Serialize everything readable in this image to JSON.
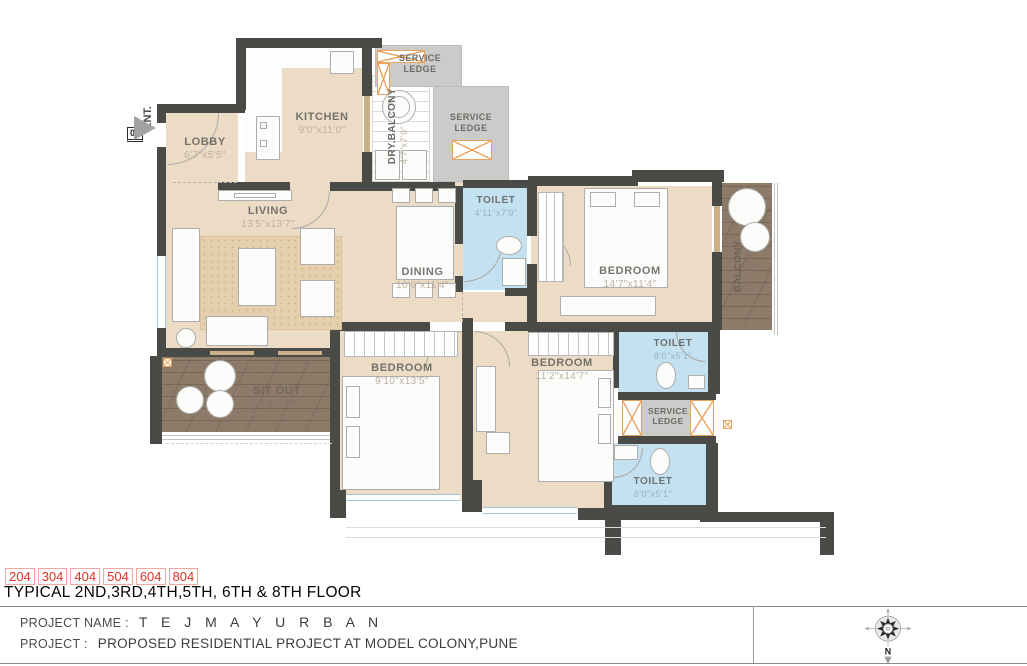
{
  "plan": {
    "entrance": {
      "unit": "04",
      "label": "ENT."
    },
    "rooms": {
      "lobby": {
        "name": "LOBBY",
        "dims": "6'7\"x5'5\""
      },
      "kitchen": {
        "name": "KITCHEN",
        "dims": "9'0\"x11'0\""
      },
      "dry_balcony": {
        "name": "DRY.BALCONY",
        "dims": "4'7\"x7'9\""
      },
      "service_ledge_top": {
        "name": "SERVICE LEDGE"
      },
      "service_ledge_right": {
        "name": "SERVICE LEDGE"
      },
      "service_ledge_mid": {
        "name": "SERVICE LEDGE"
      },
      "living": {
        "name": "LIVING",
        "dims": "13'5\"x13'7\""
      },
      "dining": {
        "name": "DINING",
        "dims": "10'6\"x11'4\""
      },
      "toilet_common": {
        "name": "TOILET",
        "dims": "4'11\"x7'9\""
      },
      "bedroom_master": {
        "name": "BEDROOM",
        "dims": "14'7\"x11'4\""
      },
      "balcony": {
        "name": "BALCONY",
        "dims": "4'7\"x11'4\""
      },
      "sit_out": {
        "name": "SIT OUT",
        "dims": "13'5\"x4'5\""
      },
      "bedroom_2": {
        "name": "BEDROOM",
        "dims": "9'10\"x13'5\""
      },
      "bedroom_3": {
        "name": "BEDROOM",
        "dims": "11'2\"x14'7\""
      },
      "toilet_attached_1": {
        "name": "TOILET",
        "dims": "8'0\"x5'1\""
      },
      "toilet_attached_2": {
        "name": "TOILET",
        "dims": "8'0\"x5'1\""
      }
    }
  },
  "footer": {
    "unit_numbers": [
      "204",
      "304",
      "404",
      "504",
      "604",
      "804"
    ],
    "floor_title": "TYPICAL 2ND,3RD,4TH,5TH, 6TH & 8TH FLOOR",
    "project_name_label": "PROJECT NAME :",
    "project_name": "T E J   M A Y U R B A N",
    "project_label": "PROJECT :",
    "project_desc": "PROPOSED RESIDENTIAL PROJECT AT MODEL COLONY,PUNE",
    "compass_north": "N"
  },
  "colors": {
    "wall": "#4a4a47",
    "floor": "#ecdcc5",
    "toilet_floor": "#c3e1f1",
    "deck_wood": "#8d7b6a",
    "service_ledge": "#cbcbca",
    "unit_number_red": "#e0312a",
    "duct_hatch": "#e8a35f"
  }
}
